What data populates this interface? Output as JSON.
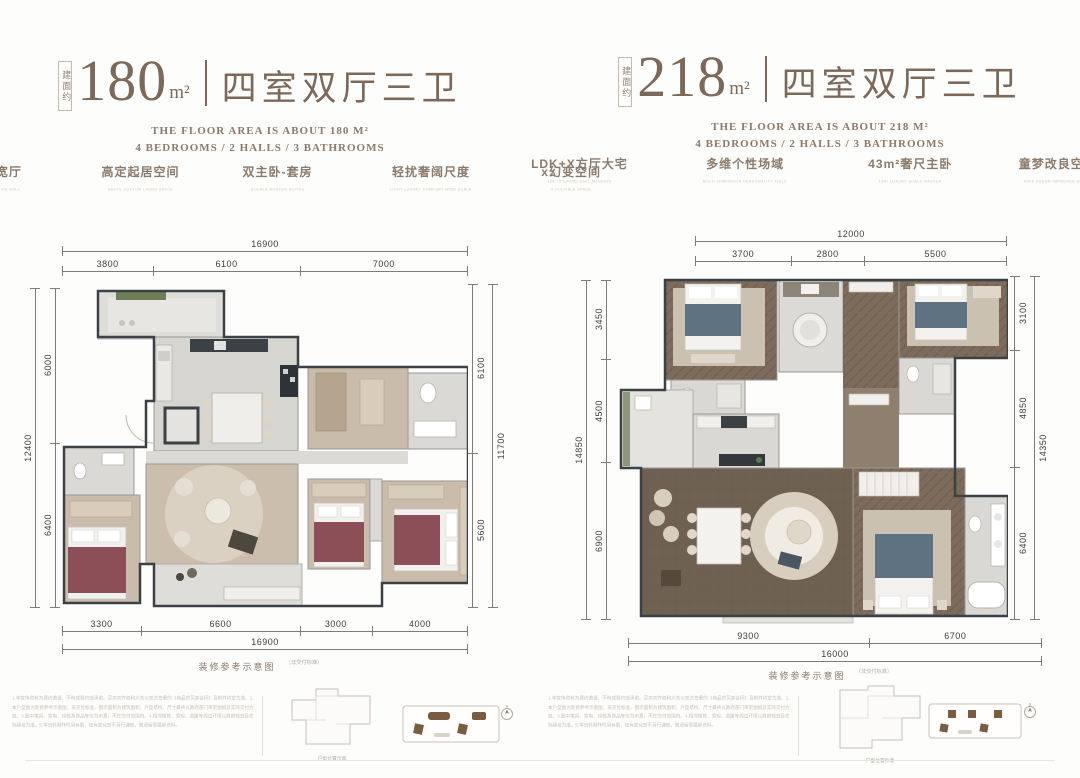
{
  "colors": {
    "accent_brown": "#7d695a",
    "tag_text": "#8b7b6c",
    "dim_text": "#3d3d3c",
    "wall": "#3c4145",
    "carpet_beige": "#c9bcab",
    "floor_light_gray": "#d7d5d0",
    "wood_herringbone": "#7d6c5b",
    "wood_plank": "#6f6151",
    "bed_red": "#8c4f57",
    "bed_blue": "#5e7282",
    "plant_green": "#6d7f57",
    "unit_marker_brown": "#7a5c40"
  },
  "plans": [
    {
      "area_prefix": "建面约",
      "area_value": "180",
      "area_unit": "m²",
      "title": "四室双厅三卫",
      "subtitle_line1": "THE FLOOR AREA IS ABOUT 180 M²",
      "subtitle_line2": "4 BEDROOMS / 2 HALLS / 3 BATHROOMS",
      "tags": [
        {
          "zh": "墅质通明宽厅",
          "en": "VILLA QUALITY BRIGHT WIDE HALL"
        },
        {
          "zh": "高定起居空间",
          "en": "HAUTE CUSTOM LIVING SPACE"
        },
        {
          "zh": "双主卧-套房",
          "en": "DOUBLE MASTER SUITES"
        },
        {
          "zh": "轻扰奢阔尺度",
          "en": "LIGHT LUXURY COMFORT WIDE SCALE"
        },
        {
          "zh": "x幻变空间",
          "en": "X FLEXIBLE SPACE"
        }
      ],
      "dims": {
        "top_total": "16900",
        "top": [
          "3800",
          "6100",
          "7000"
        ],
        "left": [
          "6000",
          "6400"
        ],
        "left_total": "12400",
        "right": [
          "6100",
          "5600"
        ],
        "right_total": "11700",
        "bottom": [
          "3300",
          "6600",
          "3000",
          "4000"
        ],
        "bottom_total": "16900"
      },
      "caption": "装修参考示意图",
      "caption_note": "（非交付标准）",
      "keyplan_caption": "户型位置示意",
      "disclaimer": "1.本宣传资料为要约邀请，不构成要约或承诺，买卖双方权利义务以双方签署的《商品房买卖合同》及附件约定为准。2.本户型图为装修参考示意图，非交付标准，图示面积为建筑面积，户型结构、尺寸最终以政府部门审定图纸及实际交付为准。3.图中家具、家电、绿植及饰品等仅为示意，不在交付范围内。4.相邻楼栋、景观、道路等周边环境以政府规划及实际建设为准。5.本资料制作时间有限，如有变化恕不另行通知，敬请留意最新资料。"
    },
    {
      "area_prefix": "建面约",
      "area_value": "218",
      "area_unit": "m²",
      "title": "四室双厅三卫",
      "subtitle_line1": "THE FLOOR AREA IS ABOUT 218 M²",
      "subtitle_line2": "4 BEDROOMS / 2 HALLS / 3 BATHROOMS",
      "tags": [
        {
          "zh": "LDK+X方厅大宅",
          "en": "LDK+X GRAND HALL MANSION"
        },
        {
          "zh": "多维个性场域",
          "en": "MULTI-DIMENSION PERSONALITY FIELD"
        },
        {
          "zh": "43m²奢尺主卧",
          "en": "43M² LUXURY SCALE MASTER"
        },
        {
          "zh": "童梦改良空间",
          "en": "KIDS DREAM IMPROVED SPACE"
        }
      ],
      "dims": {
        "top_total": "12000",
        "top": [
          "3700",
          "2800",
          "5500"
        ],
        "left": [
          "3450",
          "4500",
          "6900"
        ],
        "left_total": "14850",
        "right": [
          "3100",
          "4850",
          "6400"
        ],
        "right_total": "14350",
        "bottom": [
          "9300",
          "6700"
        ],
        "bottom_total": "16000"
      },
      "caption": "装修参考示意图",
      "caption_note": "（非交付标准）",
      "keyplan_caption": "户型位置示意",
      "disclaimer": "1.本宣传资料为要约邀请，不构成要约或承诺，买卖双方权利义务以双方签署的《商品房买卖合同》及附件约定为准。2.本户型图为装修参考示意图，非交付标准，图示面积为建筑面积，户型结构、尺寸最终以政府部门审定图纸及实际交付为准。3.图中家具、家电、绿植及饰品等仅为示意，不在交付范围内。4.相邻楼栋、景观、道路等周边环境以政府规划及实际建设为准。5.本资料制作时间有限，如有变化恕不另行通知，敬请留意最新资料。"
    }
  ]
}
